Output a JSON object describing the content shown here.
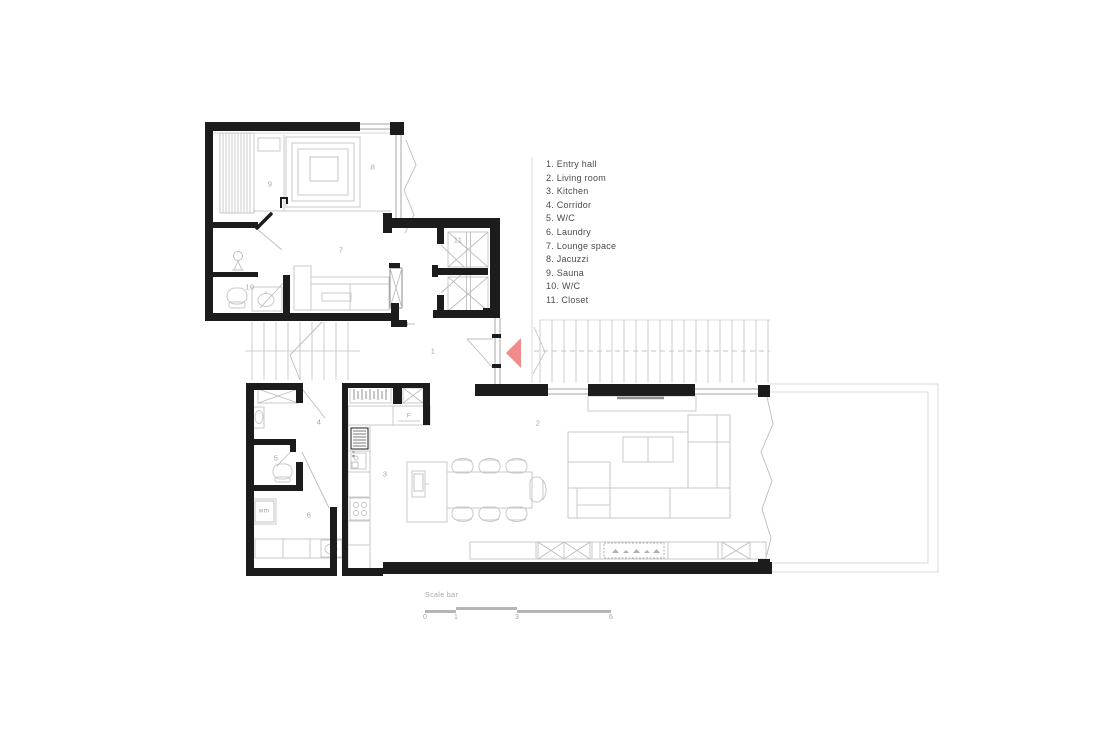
{
  "drawing_type": "architectural floor plan",
  "colors": {
    "background": "#ffffff",
    "wall": "#1c1c1c",
    "furniture_line": "#c9c9c9",
    "window_line": "#b6b6b6",
    "label_text": "#a6a6a6",
    "legend_text": "#4b4b4b",
    "scalebar": "#b5b5b5",
    "entry_arrow": "#f18a8a"
  },
  "legend": {
    "items": [
      "1. Entry hall",
      "2. Living room",
      "3. Kitchen",
      "4. Corridor",
      "5. W/C",
      "6. Laundry",
      "7. Lounge space",
      "8. Jacuzzi",
      "9. Sauna",
      "10. W/C",
      "11. Closet"
    ]
  },
  "plan_labels": {
    "entry_hall": "1",
    "living_room": "2",
    "kitchen": "3",
    "corridor": "4",
    "wc": "5",
    "laundry": "6",
    "lounge_space": "7",
    "jacuzzi": "8",
    "sauna": "9",
    "wc_upper": "10",
    "closet": "11",
    "fridge": "F",
    "washing_machine": "wm"
  },
  "scale_bar": {
    "label": "Scale bar",
    "ticks": [
      "0",
      "1",
      "3",
      "6"
    ]
  }
}
